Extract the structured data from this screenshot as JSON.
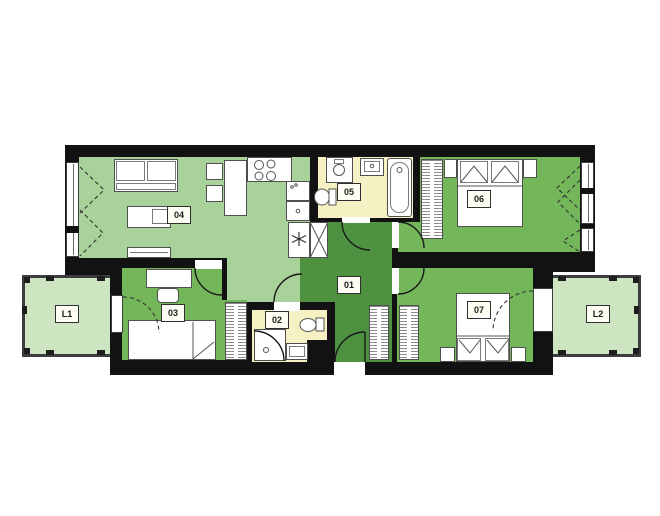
{
  "rooms": {
    "r01": {
      "label": "01"
    },
    "r02": {
      "label": "02"
    },
    "r03": {
      "label": "03"
    },
    "r04": {
      "label": "04"
    },
    "r05": {
      "label": "05"
    },
    "r06": {
      "label": "06"
    },
    "r07": {
      "label": "07"
    },
    "l1": {
      "label": "L1"
    },
    "l2": {
      "label": "L2"
    }
  },
  "colors": {
    "wall": "#121212",
    "light": "#a9d19a",
    "mid": "#74b75a",
    "dark": "#4e9140",
    "yellow": "#f5f1c3",
    "balcony": "#cde5c0"
  }
}
